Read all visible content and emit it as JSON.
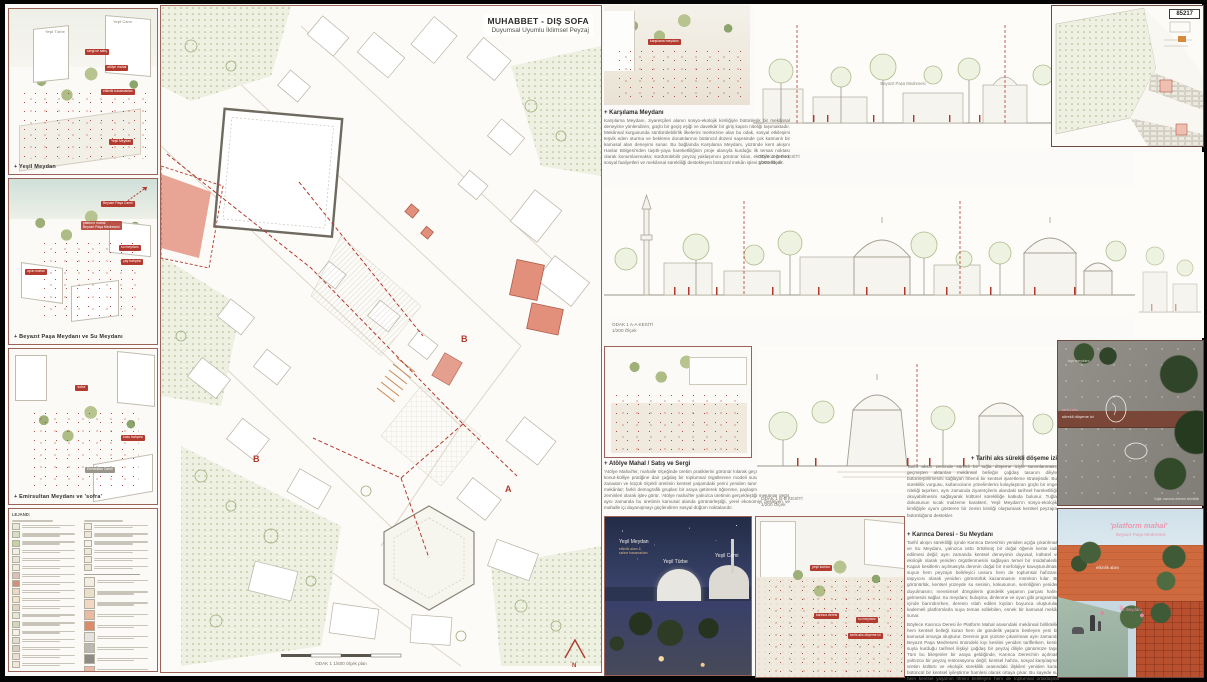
{
  "board": {
    "id": "85217",
    "title": "MUHABBET - DIŞ SOFA",
    "subtitle": "Duyumsal Uyumlu İklimsel Peyzaj"
  },
  "colors": {
    "accent_red": "#b23a2e",
    "salmon": "#e2907c",
    "olive": "#a9b584",
    "frame_brown": "#9b6257",
    "night_sky": "#2b3450",
    "brick_orange": "#cf6a3e"
  },
  "left_panels": [
    {
      "caption": "+ Yeşil Meydan",
      "labels": {
        "l1": "Yeşil Türbe",
        "l2": "Yeşil Cami"
      },
      "tags": {
        "t1": "sergi ve satış",
        "t2": "atölye mahal",
        "t3": "etkinlik basamakları",
        "t4": "Yeşil Meydan"
      }
    },
    {
      "caption": "+ Beyazıt Paşa Meydanı ve Su Meydanı",
      "labels": {
        "l1": "Beyazıt Paşa Camii"
      },
      "tags": {
        "t1": "platform mahal\nBeyazıt Paşa Medresesi",
        "t2": "su meydanı",
        "t3": "çay bahçesi",
        "t4": "oyun mahal"
      }
    },
    {
      "caption": "+ Emirsultan Meydanı ve 'sofra'",
      "labels": {
        "l1": "Emirsultan Camii"
      },
      "tags": {
        "t1": "'sofra'",
        "t2": "koku bahçesi"
      }
    }
  ],
  "legend": {
    "title": "LEJAND:",
    "left_rows": [
      "#e6ebd8",
      "#d5dfc1",
      "#c4d2a6",
      "#eef0e4",
      "#e9e5d6",
      "#f0ece0",
      "#dcc1b8",
      "#cf8f7e",
      "#e8dac8",
      "#f1e4c9",
      "#ded6c2",
      "#e3e8d4",
      "#cfd8ba",
      "#f4f1e8",
      "#e0ddd2",
      "#d8cfc0",
      "#eadfd2",
      "#f0e8da"
    ],
    "mid_rows": [
      "#f2efe6",
      "#ece7da",
      "#f4f1ea",
      "#efe9dc",
      "#f1ece2",
      "#ece6d8"
    ],
    "chips": [
      "#f1ede2",
      "#eadfca",
      "#f2d8c2",
      "#eab9a0",
      "#dd8a68",
      "#e3e3df",
      "#b9b9b4",
      "#8e8c86",
      "#e8b8a8",
      "#f0e6d2"
    ]
  },
  "plan": {
    "scale_note": "ODAK 1 1/500 ölçek plan",
    "north": "N",
    "cut_a": "A",
    "cut_b": "B"
  },
  "sections": [
    {
      "label": "ODAK 2 B-B KESİTİ\n1/200 Ölçek"
    },
    {
      "label": "ODAK 1 A-A KESİTİ\n1/200 Ölçek"
    },
    {
      "label": "ODAK 1 B-B KESİTİ\n1/200 Ölçek"
    }
  ],
  "top_elevation": {
    "note": "Beyazıt Paşa Medresesi"
  },
  "render_top": {
    "tag": "karşılama meydanı"
  },
  "text_blocks": [
    {
      "heading": "+ Karşılama Meydanı",
      "body": "Karşılama Meydanı, ziyaretçileri alanın sosyo-ekolojik kimliğiyle bütünleşik bir mekânsal deneyime yönlendiren, güçlü bir geçiş eşiği ve davetkâr bir giriş kapısı niteliği taşımaktadır. Mekânsal kurgusunda sürdürülebilirlik ilkelerini merkezine alan bu odak, sosyal etkileşimi teşvik eden oturma ve bekleme donatılarının bütüncül düzeni sayesinde çok katmanlı bir kamusal alan deneyimi sunar. Bu bağlamda Karşılama Meydanı, yüzünde kent akışını Hanlar Bölgesi'nden taşıtlı-yaya hareketliliğinin proje alanıyla kurduğu ilk temas noktası olarak konumlanmakta; sürdürülebilir peyzaj yaklaşımını görünür kılan, ekolojik değerleri, sosyal faaliyetleri ve mekânsal sürekliliği destekleyen bütüncül mekân işlevi görmektedir."
    },
    {
      "heading": "+ Atölye Mahal / Satış ve Sergi",
      "body": "'Atölye Mahal'ler, mahalle ölçeğinde üretim pratiklerini görünür kılarak geçmişe özgü çarşı-konut-külliye pratiğine dair çağdaş bir toplumsal örgütlenme modeli sunar. El emeğinin, zanaatın ve küçük ölçekli üretimin kentsel yaşamdaki yerini yeniden tanımlayan bu mikro mekânlar; farklı demografik grupları bir araya getirerek öğrenme, paylaşma ve karşılaşma zeminleri olarak işlev görür. 'Atölye mahal'ler yalnızca üretimin gerçekleştiği mekânlar değil, aynı zamanda bu üretimin kamusal alanda görünürleştiği, yerel ekonomiyi besleyen ve mahalle içi dayanışmayı güçlendiren sosyal düğüm noktalarıdır."
    },
    {
      "heading": "+ Tarihi aks sürekli döşeme izi",
      "body": "Tarihi aksın zeminde sürekli bir tuğla döşeme iziyle tanımlanması, geçmişten aktarılan mekânsal belleğin çağdaş tasarım diliyle bütünleştirilmesini sağlayan önemli bir kentsel işaretleme stratejisidir. Bu süreklilik vurgusu, kullanıcıların yönelimlerini kolaylaştıran güçlü bir imge niteliği taşırken, aynı zamanda ziyaretçilerin alandaki tarihsel hareketliliği okuyabilmesini sağlayarak kültürel sürekliliğe katkıda bulunur. Tuğla dokusunun sıcak malzeme karakteri, Yeşil Meydan'ın sosyo-ekolojik kimliğiyle uyum gösteren bir zemin kimliği oluşturarak kentsel peyzajın bütünlüğünü destekler."
    },
    {
      "heading": "+ Karınca Deresi - Su Meydanı",
      "body": "Tarihî akışın sürekliliği içinde Karınca Deresi'nin yeniden açığa çıkarılması ve Su Meydanı, yalnızca üstü örtülmüş bir doğal öğenin kente iade edilmesi değil; aynı zamanda kentsel deneyimin duyusal, kültürel ve ekolojik olarak yeniden örgütlenmesini sağlayan temel bir müdahaledir. Kapalı kesitlerin açılmasıyla derenin doğal bir morfolojiye kavuşturulması, suyun hem peyzajın belirleyici unsuru hem de toplumsal hafızanın taşıyıcısı olarak yeniden görünürlük kazanmasını mümkün kılar. Bu görünürlük, kentsel yüzeyde su sesinin, kokusunun, serinliğinin yeniden duyulmasını; mevsimsel döngülerin gündelik yaşamın parçası haline gelmesini sağlar. Su meydanı; buluşma, dinlenme ve oyun gibi programları içinde barındırırken, derenin ıslah edilen kıyıları boyunca oluşturulan kademeli platformlarla suya temas edilebilen, esnek bir kamusal mekân sunar.",
      "body2": "Böylece Karınca Deresi ile Platform Mahal arasındaki mekânsal birliktelik, hem kentsel belleği kuran hem de gündelik yaşamı besleyen yeni bir kamusal omurga oluşturur. Derenin gün yüzüne çıkarılması aynı zamanda Beyazıt Paşa Medresesi önündeki kıyı kesitini yeniden tariflerken, kentin suyla kurduğu tarihsel ilişkiyi çağdaş bir peyzaj diliyle günümüze taşır. Tüm bu bileşenler bir araya geldiğinde, Karınca Deresi'nin açılması yalnızca bir peyzaj restorasyonu değil; kentsel hafıza, sosyal karşılaşma, üretim kültürü ve ekolojik süreklilik arasındaki ilişkileri yeniden kuran bütüncül bir kentsel iyileştirme hamlesi olarak ortaya çıkar. Bu sayede su, hem kentsel yaşamın ritmini belirleyen hem de toplumsal ortaklaşma imkânlarını genişleten aktif bir karşılaşma zemini haline gelir."
    }
  ],
  "night_render": {
    "meydan": "Yeşil Meydan",
    "meydan_sub": "etkinlik alanı &\nsahne basamakları",
    "turbe": "Yeşil Türbe",
    "cami": "Yeşil Cami"
  },
  "street_render": {
    "t1": "yeşil koridor",
    "t2": "karınca deresi",
    "t3": "su meydanı",
    "t4": "tarihi aks döşeme izi"
  },
  "pavement_photo": {
    "l1": "kıyı meydanı",
    "l2": "tarihi aks",
    "l3": "sürekli döşeme izi",
    "l4": "tuğla: zamana direnen süreklilik"
  },
  "platform_photo": {
    "title": "'platform mahal'",
    "subtitle": "Beyazıt Paşa Medresesi",
    "l1": "etkinlik alanı",
    "l2": "su meydanı"
  }
}
